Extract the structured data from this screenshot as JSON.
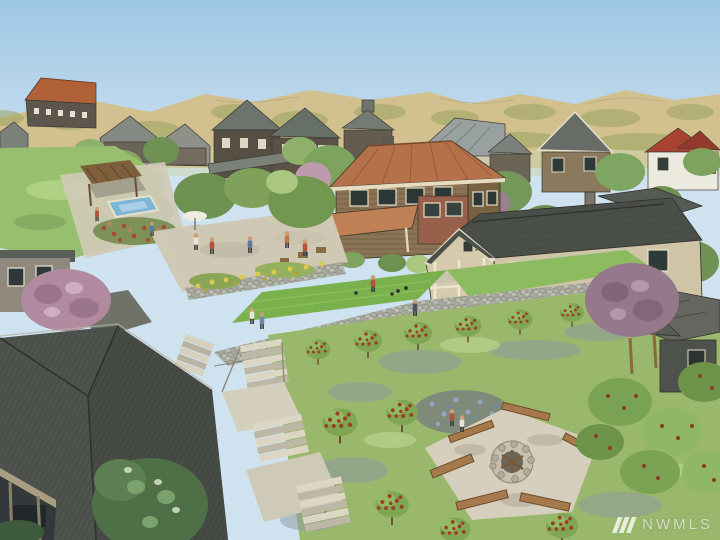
{
  "watermark": {
    "logo_icon": "nwmls-triple-slash-icon",
    "text": "NWMLS"
  },
  "palette": {
    "sky_top": "#9dc7e5",
    "sky_bottom": "#cfe2ef",
    "hill": "#d2c08e",
    "hill_olive": "#9aa363",
    "foliage_dark": "#5f7f4b",
    "foliage": "#7da35e",
    "foliage_light": "#a9c77f",
    "lawn": "#98bf6e",
    "court": "#79b14c",
    "path": "#d0cab6",
    "stone": "#a8a99e",
    "roof_terracotta": "#b4714a",
    "roof_charcoal": "#4b4f49",
    "roof_gray": "#7d827d",
    "roof_slate": "#4f534e",
    "wall_cream": "#d5cbac",
    "wall_brown": "#8b7355",
    "wall_dark": "#5c5548",
    "water": "#7db5d5",
    "flower_red": "#a84a38",
    "flower_yellow": "#d9c94f",
    "flower_blue": "#8fa8c8",
    "blossom_pink": "#b18aa0",
    "blossom_purple": "#96788c",
    "bench": "#a5794c",
    "white_house": "#eceadf",
    "red_roof": "#a84332"
  },
  "scene": {
    "type": "watercolor aerial rendering",
    "elements": [
      "sky",
      "foothills",
      "background-houses",
      "barn",
      "central-house",
      "craftsman-house",
      "pool",
      "pergola",
      "patio",
      "bocce-court",
      "stone-walls",
      "stairs",
      "orchard",
      "fire-pit",
      "benches",
      "foreground-roof",
      "pink-blossom-tree",
      "purple-blossom-tree",
      "people"
    ]
  }
}
